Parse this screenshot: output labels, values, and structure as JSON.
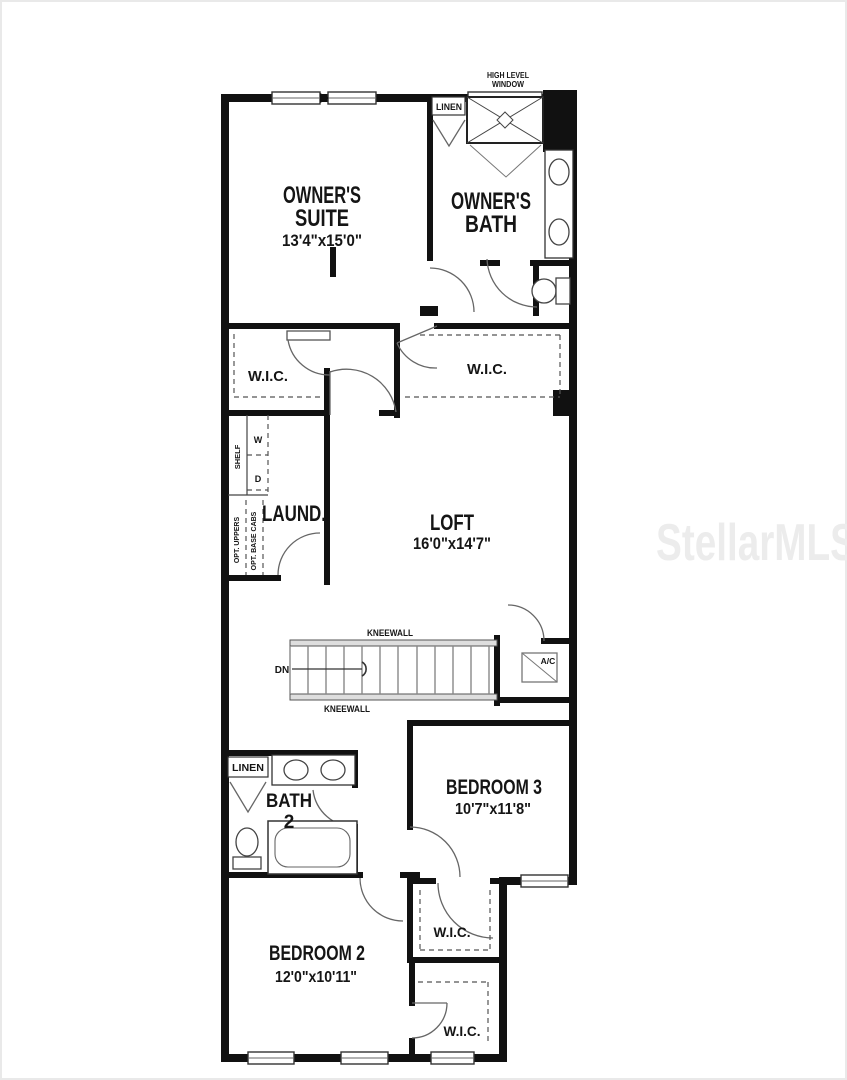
{
  "watermark": "StellarMLS",
  "rooms": {
    "owners_suite": {
      "line1": "OWNER'S",
      "line2": "SUITE",
      "dims": "13'4\"x15'0\""
    },
    "owners_bath": {
      "line1": "OWNER'S",
      "line2": "BATH"
    },
    "wic_left": {
      "label": "W.I.C."
    },
    "wic_right": {
      "label": "W.I.C."
    },
    "laundry": {
      "label": "LAUND."
    },
    "loft": {
      "label": "LOFT",
      "dims": "16'0\"x14'7\""
    },
    "bath2": {
      "line1": "BATH",
      "line2": "2"
    },
    "bedroom3": {
      "label": "BEDROOM 3",
      "dims": "10'7\"x11'8\""
    },
    "bedroom2": {
      "label": "BEDROOM 2",
      "dims": "12'0\"x10'11\""
    },
    "wic_mid": {
      "label": "W.I.C."
    },
    "wic_bottom": {
      "label": "W.I.C."
    }
  },
  "annotations": {
    "high_level_window_line1": "HIGH LEVEL",
    "high_level_window_line2": "WINDOW",
    "linen_top": "LINEN",
    "linen_bath2": "LINEN",
    "kneewall_top": "KNEEWALL",
    "kneewall_bottom": "KNEEWALL",
    "down": "DN",
    "ac": "A/C",
    "shelf": "SHELF",
    "opt_uppers": "OPT. UPPERS",
    "opt_base_cabs": "OPT. BASE CABS",
    "washer": "W",
    "dryer": "D"
  },
  "colors": {
    "wall": "#111111",
    "text": "#151515",
    "fixture": "#444444",
    "dashes": "#555555",
    "watermark": "#ececec",
    "background": "#ffffff"
  }
}
